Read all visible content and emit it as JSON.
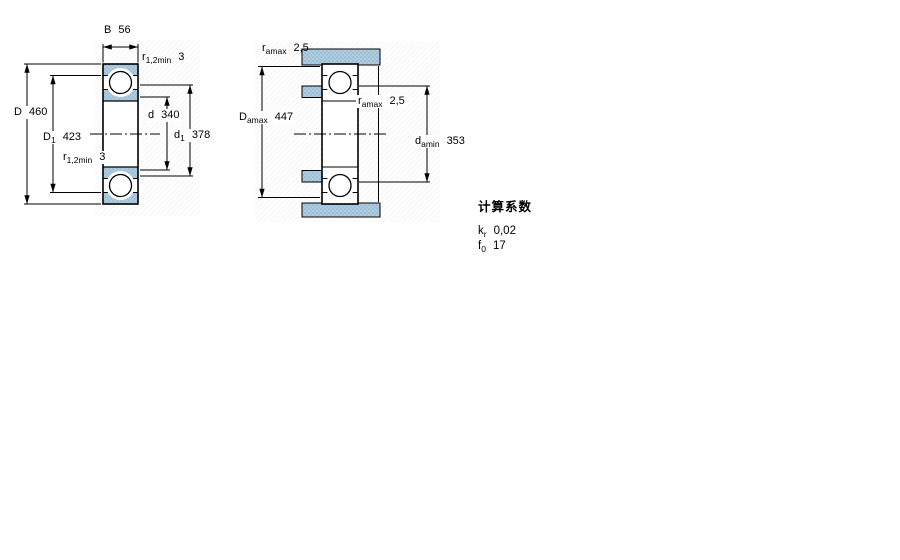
{
  "page": {
    "title": "Bearing dimension drawing"
  },
  "figure_left": {
    "name": "bearing-cross-section",
    "dims": {
      "B": {
        "base": "B",
        "sub": "",
        "value": "56"
      },
      "r_top": {
        "base": "r",
        "sub": "1,2min",
        "value": "3"
      },
      "D": {
        "base": "D",
        "sub": "",
        "value": "460"
      },
      "D1": {
        "base": "D",
        "sub": "1",
        "value": "423"
      },
      "r_bottom": {
        "base": "r",
        "sub": "1,2min",
        "value": "3"
      },
      "d": {
        "base": "d",
        "sub": "",
        "value": "340"
      },
      "d1": {
        "base": "d",
        "sub": "1",
        "value": "378"
      }
    }
  },
  "figure_right": {
    "name": "abutment-and-fillet-dimensions",
    "dims": {
      "ra_top": {
        "base": "r",
        "sub": "amax",
        "value": "2,5"
      },
      "Da": {
        "base": "D",
        "sub": "amax",
        "value": "447"
      },
      "ra_mid": {
        "base": "r",
        "sub": "amax",
        "value": "2,5"
      },
      "da": {
        "base": "d",
        "sub": "amin",
        "value": "353"
      }
    }
  },
  "calculation_factors": {
    "title": "计算系数",
    "rows": [
      {
        "base": "k",
        "sub": "r",
        "value": "0,02"
      },
      {
        "base": "f",
        "sub": "0",
        "value": "17"
      }
    ]
  },
  "colors": {
    "background": "#ffffff",
    "line": "#000000",
    "hatch_fill": "#aecbdf",
    "hatch_dot": "#7fa8c3",
    "faint_texture": "#ededed"
  }
}
